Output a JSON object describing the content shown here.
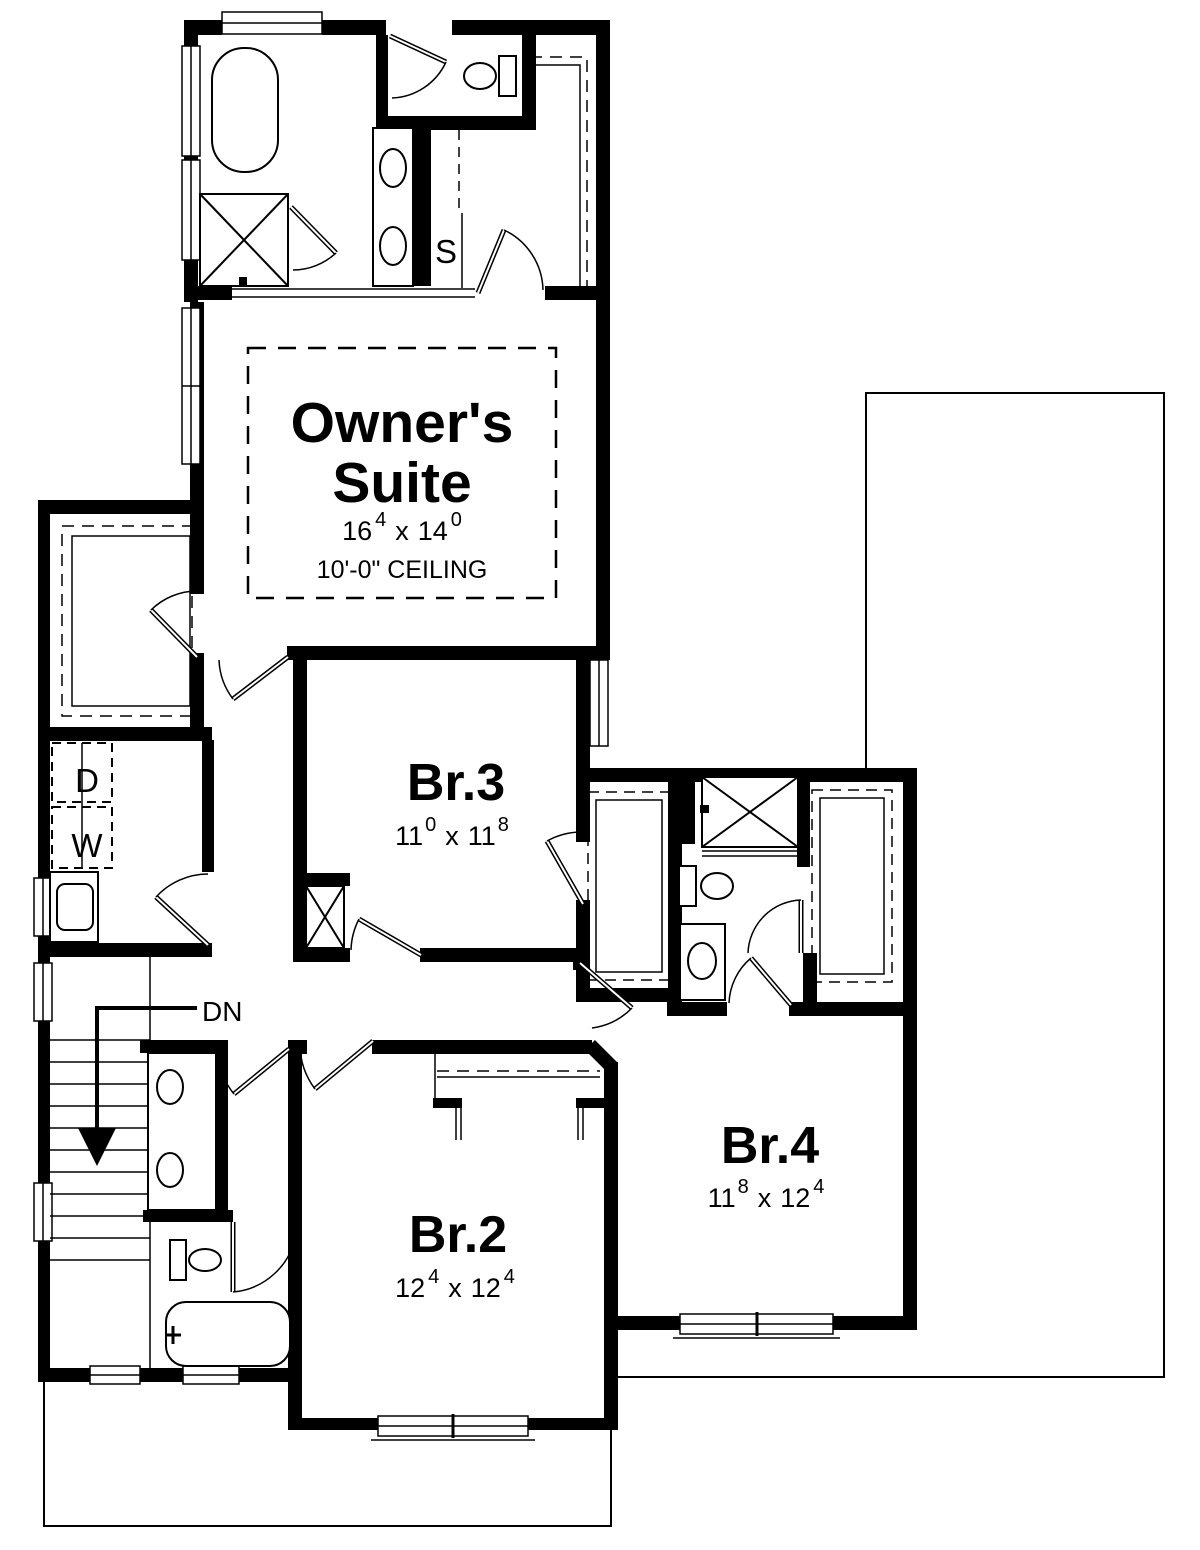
{
  "plan": {
    "title": "Second floor plan",
    "colors": {
      "line": "#000000",
      "background": "#ffffff"
    },
    "rooms": {
      "owners_suite": {
        "line1": "Owner's",
        "line2": "Suite",
        "dims": {
          "w": "16",
          "w_sup": "4",
          "sep": "x",
          "l": "14",
          "l_sup": "0"
        },
        "ceiling": "10'-0\" CEILING"
      },
      "br3": {
        "name": "Br.3",
        "dims": {
          "w": "11",
          "w_sup": "0",
          "sep": "x",
          "l": "11",
          "l_sup": "8"
        }
      },
      "br2": {
        "name": "Br.2",
        "dims": {
          "w": "12",
          "w_sup": "4",
          "sep": "x",
          "l": "12",
          "l_sup": "4"
        }
      },
      "br4": {
        "name": "Br.4",
        "dims": {
          "w": "11",
          "w_sup": "8",
          "sep": "x",
          "l": "12",
          "l_sup": "4"
        }
      }
    },
    "labels": {
      "down": "DN",
      "shelves": "S",
      "dryer": "D",
      "washer": "W"
    },
    "icons": [
      "soaking-tub-icon",
      "shower-icon",
      "double-vanity-icon",
      "toilet-icon",
      "bathtub-icon",
      "washer-icon",
      "dryer-icon",
      "laundry-sink-icon",
      "stairs-icon",
      "down-arrow-icon",
      "closet-shelf-icon",
      "window-icon",
      "door-swing-icon"
    ]
  }
}
